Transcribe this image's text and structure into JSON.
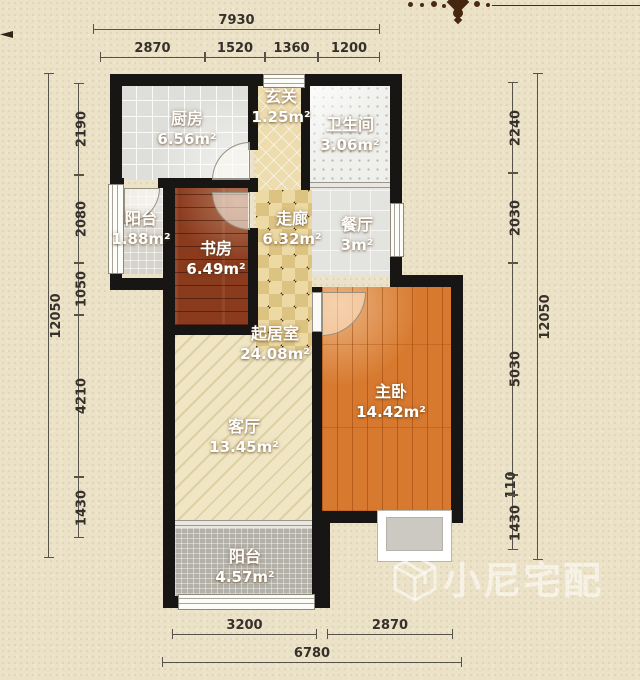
{
  "rooms": {
    "kitchen": {
      "name": "厨房",
      "area": "6.56m²"
    },
    "entry": {
      "name": "玄关",
      "area": "1.25m²"
    },
    "bathroom": {
      "name": "卫生间",
      "area": "3.06m²"
    },
    "balcony_north": {
      "name": "阳台",
      "area": "1.88m²"
    },
    "study": {
      "name": "书房",
      "area": "6.49m²"
    },
    "corridor": {
      "name": "走廊",
      "area": "6.32m²"
    },
    "dining": {
      "name": "餐厅",
      "area": "3m²"
    },
    "living_area": {
      "name": "起居室",
      "area": "24.08m²"
    },
    "master_bedroom": {
      "name": "主卧",
      "area": "14.42m²"
    },
    "living_room": {
      "name": "客厅",
      "area": "13.45m²"
    },
    "balcony_south": {
      "name": "阳台",
      "area": "4.57m²"
    }
  },
  "dimensions": {
    "top": {
      "total": "7930",
      "segments": [
        "2870",
        "1520",
        "1360",
        "1200"
      ]
    },
    "bottom": {
      "total": "6780",
      "segments": [
        "3200",
        "2870"
      ]
    },
    "left": {
      "total": "12050",
      "segments": [
        "2190",
        "2080",
        "1050",
        "4210",
        "1430"
      ]
    },
    "right": {
      "total": "12050",
      "segments": [
        "2240",
        "2030",
        "5030",
        "110",
        "1430"
      ]
    }
  },
  "watermark": {
    "text": "小尼宅配"
  },
  "colors": {
    "wall": "#181614",
    "study_floor": "#8a3a1d",
    "master_floor": "#d7792e",
    "corridor_floor": "#ecd9a4",
    "background": "#ece2c8",
    "label_text": "#ffffff",
    "dimension_text": "#35302a"
  }
}
